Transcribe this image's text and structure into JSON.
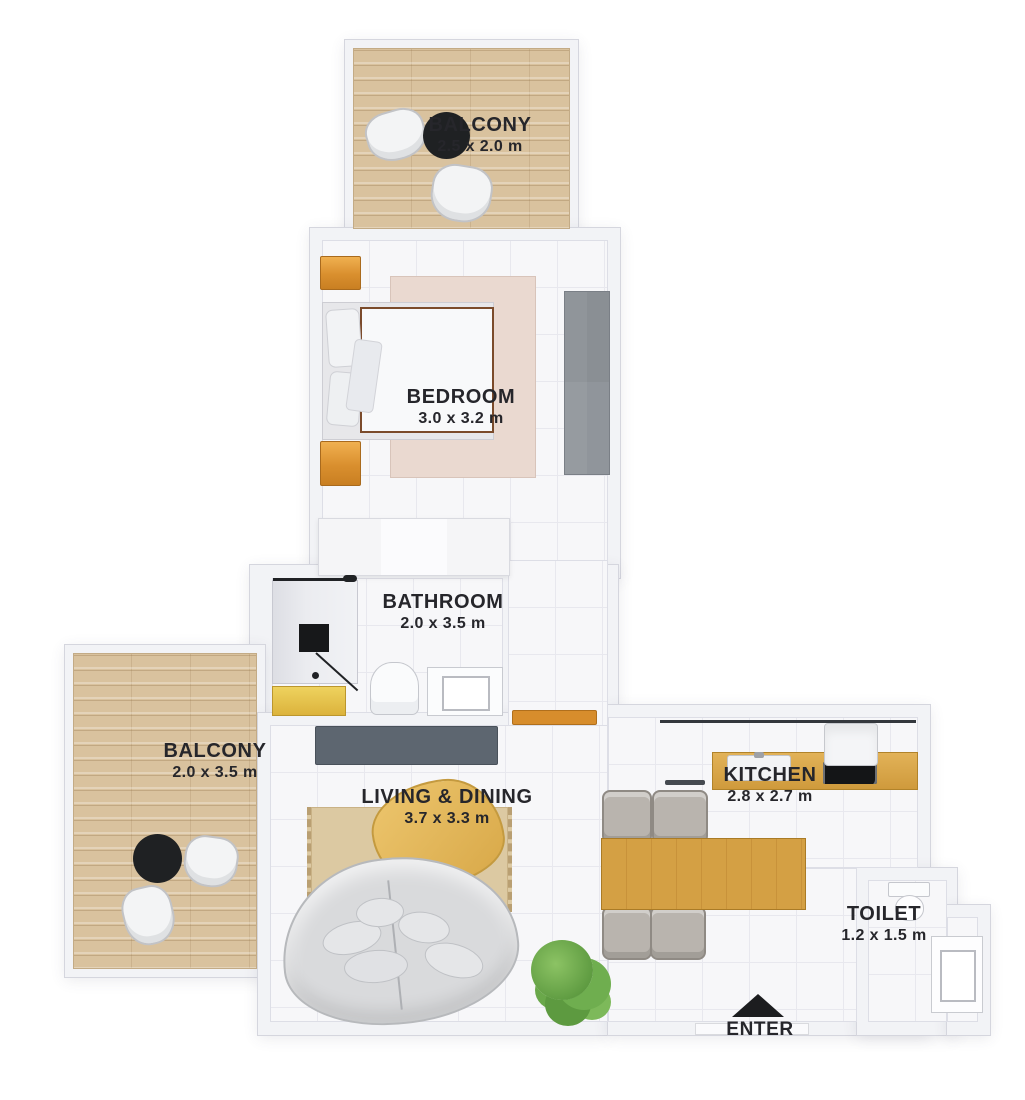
{
  "plan": {
    "type": "apartment-floor-plan",
    "view": "top-down-3d-render"
  },
  "rooms": [
    {
      "id": "balcony-top",
      "name": "BALCONY",
      "dims": "2.5 x 2.0 m"
    },
    {
      "id": "bedroom",
      "name": "BEDROOM",
      "dims": "3.0 x 3.2 m"
    },
    {
      "id": "bathroom",
      "name": "BATHROOM",
      "dims": "2.0 x 3.5 m"
    },
    {
      "id": "balcony-left",
      "name": "BALCONY",
      "dims": "2.0 x 3.5 m"
    },
    {
      "id": "living-dining",
      "name": "LIVING & DINING",
      "dims": "3.7 x 3.3 m"
    },
    {
      "id": "kitchen",
      "name": "KITCHEN",
      "dims": "2.8 x 2.7 m"
    },
    {
      "id": "toilet",
      "name": "TOILET",
      "dims": "1.2 x 1.5 m"
    }
  ],
  "entry": {
    "label": "ENTER"
  },
  "furniture": {
    "balcony_top": [
      "round-table",
      "chair",
      "chair"
    ],
    "bedroom": [
      "double-bed",
      "nightstand",
      "nightstand",
      "rug",
      "wardrobe"
    ],
    "hall": [
      "closet",
      "shelf"
    ],
    "bathroom": [
      "shower",
      "shower-mat",
      "vanity",
      "toilet",
      "sink"
    ],
    "balcony_left": [
      "round-table",
      "chair",
      "chair"
    ],
    "living_dining": [
      "tv-console",
      "rug",
      "coffee-table",
      "curved-sofa",
      "plant"
    ],
    "kitchen": [
      "counter",
      "sink",
      "cooktop",
      "fridge",
      "dining-table",
      "chair",
      "chair",
      "chair",
      "chair"
    ],
    "toilet_room": [
      "toilet",
      "sink"
    ]
  },
  "colors": {
    "background": "#ffffff",
    "wall": "#f2f3f6",
    "tile_floor": "#f7f7f9",
    "wood_floor": "#d9c29e",
    "label_text": "#26262b",
    "accent_wood": "#d9a74a",
    "dark_fixture": "#1f2123",
    "wardrobe_gray": "#90959b",
    "sofa_gray": "#d9dadc",
    "plant_green": "#6fae4f"
  }
}
